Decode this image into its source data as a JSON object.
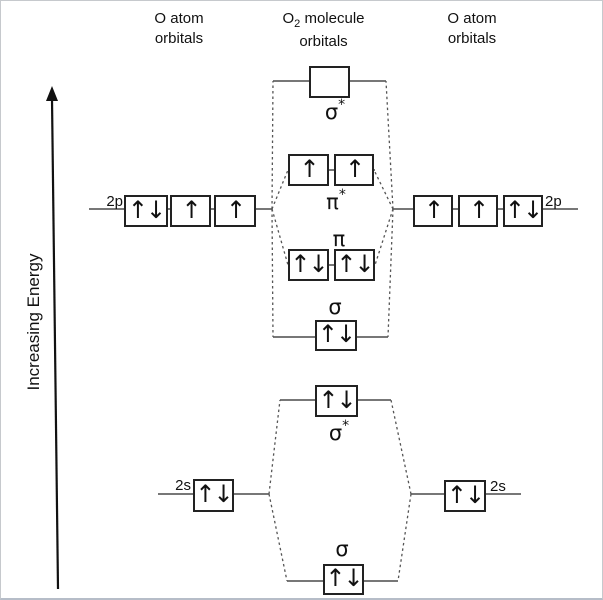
{
  "headers": {
    "left": {
      "line1": "O atom",
      "line2": "orbitals"
    },
    "center": {
      "o": "O",
      "sub": "2",
      "molecule": " molecule",
      "line2": "orbitals"
    },
    "right": {
      "line1": "O atom",
      "line2": "orbitals"
    }
  },
  "energy_axis": {
    "label": "Increasing Energy"
  },
  "atomic_orbitals": {
    "left": {
      "p_label": "2p",
      "s_label": "2s",
      "p_boxes": [
        "↑↓",
        "↑",
        "↑"
      ],
      "s_box": "↑↓"
    },
    "right": {
      "p_label": "2p",
      "s_label": "2s",
      "p_boxes": [
        "↑",
        "↑",
        "↑↓"
      ],
      "s_box": "↑↓"
    }
  },
  "molecular_orbitals": {
    "sigma_star_2p": {
      "symbol": "σ",
      "star": "*",
      "electrons": [
        ""
      ]
    },
    "pi_star_2p": {
      "symbol": "π",
      "star": "*",
      "electrons": [
        "↑",
        "↑"
      ]
    },
    "pi_2p": {
      "symbol": "π",
      "electrons": [
        "↑↓",
        "↑↓"
      ]
    },
    "sigma_2p": {
      "symbol": "σ",
      "electrons": [
        "↑↓"
      ]
    },
    "sigma_star_2s": {
      "symbol": "σ",
      "star": "*",
      "electrons": [
        "↑↓"
      ]
    },
    "sigma_2s": {
      "symbol": "σ",
      "electrons": [
        "↑↓"
      ]
    }
  },
  "colors": {
    "line": "#4a4a4a",
    "dotted_line": "#555555",
    "box_border": "#222222",
    "arrow_axis": "#111111",
    "background": "#ffffff",
    "frame_border": "#c6c9cd"
  }
}
